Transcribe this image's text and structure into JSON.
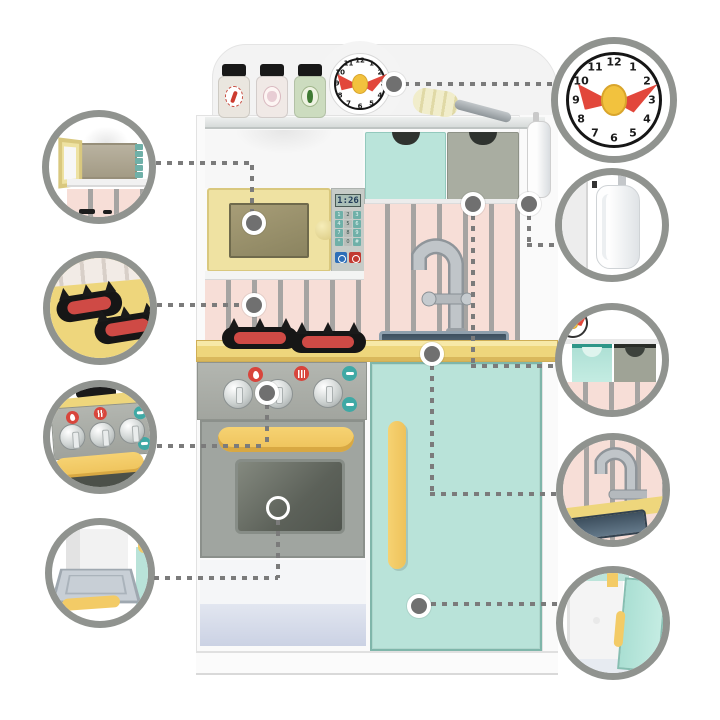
{
  "clock": {
    "numbers": [
      "12",
      "1",
      "2",
      "3",
      "4",
      "5",
      "6",
      "7",
      "8",
      "9",
      "10",
      "11"
    ]
  },
  "microwave": {
    "display": "1:26",
    "keys": [
      "1",
      "2",
      "3",
      "4",
      "5",
      "6",
      "7",
      "8",
      "9",
      "*",
      "0",
      "#"
    ]
  },
  "jars": [
    {
      "label_icon": "chili-pepper-icon"
    },
    {
      "label_icon": "garlic-icon"
    },
    {
      "label_icon": "leaf-icon"
    }
  ],
  "callouts": {
    "left": [
      {
        "feature": "microwave-door-open"
      },
      {
        "feature": "stove-burners"
      },
      {
        "feature": "oven-knobs-and-handle"
      },
      {
        "feature": "fold-down-oven-door"
      }
    ],
    "right": [
      {
        "feature": "play-clock"
      },
      {
        "feature": "side-phone"
      },
      {
        "feature": "storage-drawers"
      },
      {
        "feature": "sink-and-faucet"
      },
      {
        "feature": "cabinet-door-open"
      }
    ]
  },
  "colors": {
    "mint": "#b9e3d9",
    "handle_yellow": "#f2c75e",
    "counter_yellow": "#eed67c",
    "backsplash_pink": "#f7ded7",
    "panel_gray": "#a7aaa4",
    "burner_red": "#cf4a45",
    "badge_red": "#d8453c",
    "badge_teal": "#3fa9a5",
    "sink_blue": "#5f7586",
    "callout_border": "#90938f",
    "connector_gray": "#7b7b7b",
    "hand_red": "#e2473b",
    "hand_center_yellow": "#f2c23e"
  }
}
